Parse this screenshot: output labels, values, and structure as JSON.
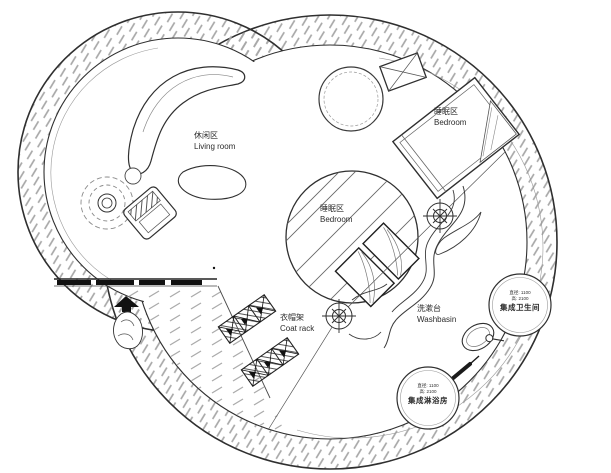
{
  "labels": {
    "living_room": {
      "zh": "休闲区",
      "en": "Living room"
    },
    "bedroom_top": {
      "zh": "睡眠区",
      "en": "Bedroom"
    },
    "bedroom_center": {
      "zh": "睡眠区",
      "en": "Bedroom"
    },
    "coat_rack": {
      "zh": "衣帽架",
      "en": "Coat rack"
    },
    "washbasin": {
      "zh": "洗漱台",
      "en": "Washbasin"
    },
    "bathroom_pod": {
      "dim1": "直径: 1100",
      "dim2": "高: 2100",
      "name": "集成卫生间"
    },
    "shower_pod": {
      "dim1": "直径: 1100",
      "dim2": "高: 2100",
      "name": "集成淋浴房"
    }
  },
  "symbols": {
    "survey_marker": "crosshair-target",
    "plant": "potted-plant-scribble",
    "statue": "garden-figure-with-black-canopy",
    "washbasin": "oval-basin-with-tap",
    "crossed_box": "rectangle-with-x",
    "window_wall": "black-glazing-segments"
  },
  "colors": {
    "line": "#2f2f2f",
    "wall_hatch": "#a8a8a8",
    "deck_hatch": "#ababab",
    "background": "#ffffff",
    "window_fill": "#111111"
  }
}
